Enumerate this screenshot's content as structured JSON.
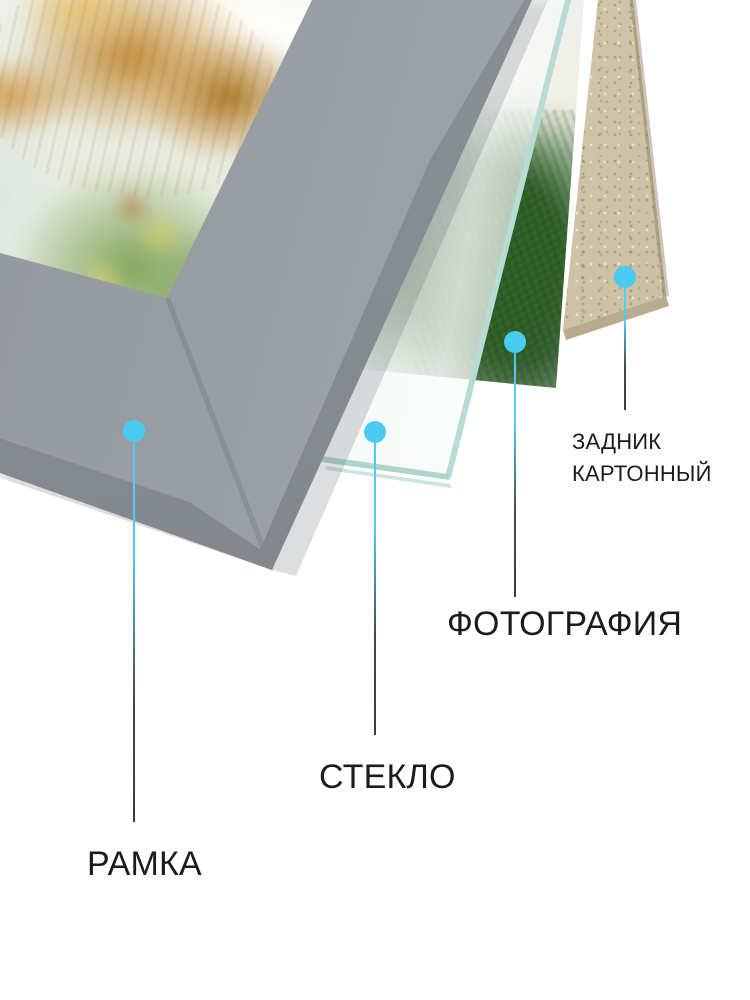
{
  "diagram": {
    "callouts": [
      {
        "id": "frame",
        "label": "РАМКА"
      },
      {
        "id": "glass",
        "label": "СТЕКЛО"
      },
      {
        "id": "photo",
        "label": "ФОТОГРАФИЯ"
      },
      {
        "id": "backing",
        "label": "ЗАДНИК КАРТОННЫЙ",
        "label_line1": "ЗАДНИК",
        "label_line2": "КАРТОННЫЙ"
      }
    ],
    "colors": {
      "dot": "#4accf2",
      "line_top": "#4fcdf2",
      "line_bottom": "#393d40",
      "label_text": "#1b1b1b",
      "frame_face": "#9aa0a6",
      "frame_bevel": "#83888e",
      "glass_edge": "#b7dcd5",
      "cardboard": "#cfc3a9",
      "cardboard_edge": "#a99b7c"
    }
  }
}
